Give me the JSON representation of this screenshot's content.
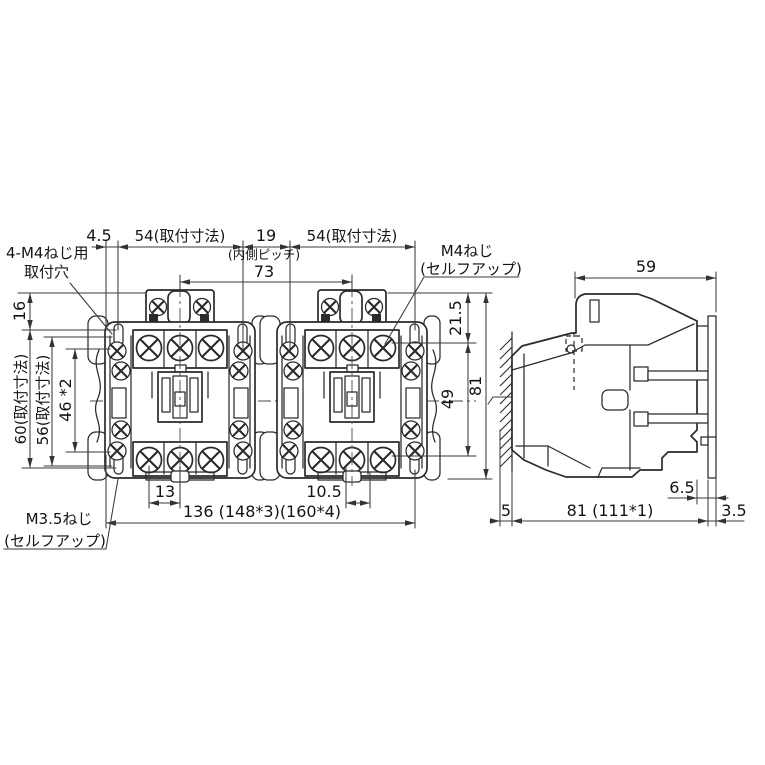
{
  "colors": {
    "line": "#2a2a2a",
    "dim_line": "#3a3a3a",
    "background": "#ffffff"
  },
  "front_view": {
    "top_dims": {
      "edge_offset": "4.5",
      "mount_pitch_left": "54(取付寸法)",
      "unit_gap": "19",
      "unit_gap_note": "(内側ピッチ)",
      "mount_pitch_right": "54(取付寸法)",
      "center_pitch": "73"
    },
    "left_dims": {
      "top_offset": "16",
      "mount_height_max": "60(取付寸法)",
      "mount_height_min": "56(取付寸法)",
      "hole_pitch": "46 *2"
    },
    "right_dims": {
      "top_to_terminal": "21.5",
      "terminal_span": "49",
      "total_height": "81"
    },
    "bottom_dims": {
      "screw_pitch_left": "13",
      "screw_offset_right": "10.5",
      "total_width": "136 (148*3)(160*4)"
    },
    "callouts": {
      "mount_hole_line1": "4-M4ねじ用",
      "mount_hole_line2": "取付穴",
      "m4_screw_line1": "M4ねじ",
      "m4_screw_line2": "(セルフアップ)",
      "m35_screw_line1": "M3.5ねじ",
      "m35_screw_line2": "(セルフアップ)"
    }
  },
  "side_view": {
    "dims": {
      "head_width": "59",
      "rail_depth": "6.5",
      "panel_gap": "5",
      "total_depth": "81 (111*1)",
      "plate_thickness": "3.5"
    }
  }
}
